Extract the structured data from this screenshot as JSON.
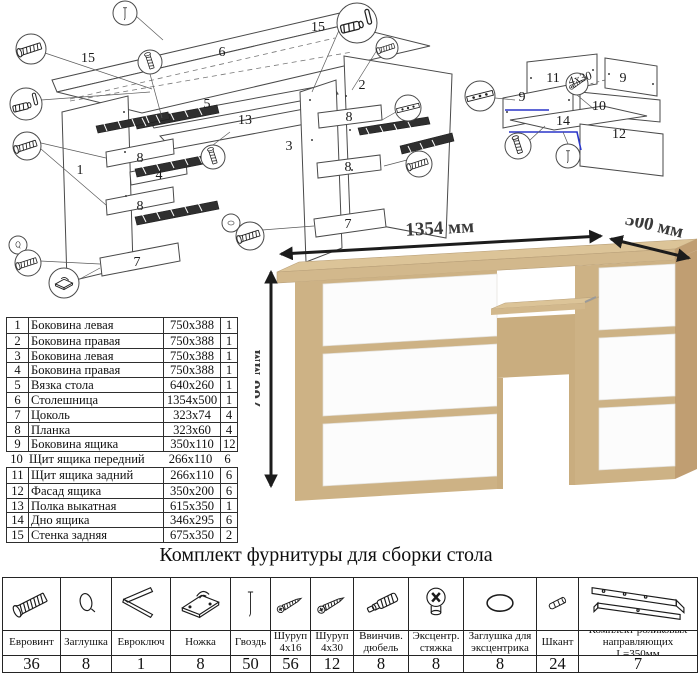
{
  "title": "Комплект фурнитуры для сборки стола",
  "render": {
    "width_label": "1354 мм",
    "depth_label": "500 мм",
    "height_label": "766 мм"
  },
  "colors": {
    "oak_top": "#dcc498",
    "oak_front": "#d2b88c",
    "oak_side": "#c09e72",
    "oak_inner": "#c9ad7f",
    "oak_mid": "#cdb285",
    "white_front": "#fcfcfc",
    "white_edge": "#e3e0da",
    "arrow": "#1c1c1c",
    "dim_text": "#3a3a3a",
    "line": "#4a4a4a",
    "highlight_blue": "#2a35c8"
  },
  "parts_table": {
    "rows": [
      {
        "num": "1",
        "name": "Боковина левая",
        "size": "750x388",
        "qty": "1"
      },
      {
        "num": "2",
        "name": "Боковина правая",
        "size": "750x388",
        "qty": "1"
      },
      {
        "num": "3",
        "name": "Боковина левая",
        "size": "750x388",
        "qty": "1"
      },
      {
        "num": "4",
        "name": "Боковина правая",
        "size": "750x388",
        "qty": "1"
      },
      {
        "num": "5",
        "name": "Вязка стола",
        "size": "640x260",
        "qty": "1"
      },
      {
        "num": "6",
        "name": "Столешница",
        "size": "1354x500",
        "qty": "1"
      },
      {
        "num": "7",
        "name": "Цоколь",
        "size": "323x74",
        "qty": "4"
      },
      {
        "num": "8",
        "name": "Планка",
        "size": "323x60",
        "qty": "4"
      },
      {
        "num": "9",
        "name": "Боковина ящика",
        "size": "350x110",
        "qty": "12"
      },
      {
        "num": "10",
        "name": "Щит ящика передний",
        "size": "266x110",
        "qty": "6"
      },
      {
        "num": "11",
        "name": "Щит ящика задний",
        "size": "266x110",
        "qty": "6"
      },
      {
        "num": "12",
        "name": "Фасад ящика",
        "size": "350x200",
        "qty": "6"
      },
      {
        "num": "13",
        "name": "Полка выкатная",
        "size": "615x350",
        "qty": "1"
      },
      {
        "num": "14",
        "name": "Дно ящика",
        "size": "346x295",
        "qty": "6"
      },
      {
        "num": "15",
        "name": "Стенка задняя",
        "size": "675x350",
        "qty": "2"
      }
    ]
  },
  "hardware": {
    "items": [
      {
        "name": "Евровинт",
        "qty": "36",
        "icon": "euro-screw"
      },
      {
        "name": "Заглушка",
        "qty": "8",
        "icon": "cap"
      },
      {
        "name": "Евроключ",
        "qty": "1",
        "icon": "hex-key"
      },
      {
        "name": "Ножка",
        "qty": "8",
        "icon": "foot"
      },
      {
        "name": "Гвоздь",
        "qty": "50",
        "icon": "nail"
      },
      {
        "name": "Шуруп 4х16",
        "qty": "56",
        "icon": "screw"
      },
      {
        "name": "Шуруп 4х30",
        "qty": "12",
        "icon": "screw"
      },
      {
        "name": "Ввинчив. дюбель",
        "qty": "8",
        "icon": "dowel-threaded"
      },
      {
        "name": "Эксцентр. стяжка",
        "qty": "8",
        "icon": "cam-lock"
      },
      {
        "name": "Заглушка для эксцентрика",
        "qty": "8",
        "icon": "oval-cap"
      },
      {
        "name": "Шкант",
        "qty": "24",
        "icon": "wood-dowel"
      },
      {
        "name": "Комплект роликовых направляющих L=350мм",
        "qty": "7",
        "icon": "drawer-slide"
      }
    ]
  },
  "diagram_main": {
    "labels": [
      {
        "t": "15",
        "x": 88,
        "y": 62
      },
      {
        "t": "6",
        "x": 222,
        "y": 56
      },
      {
        "t": "15",
        "x": 318,
        "y": 31
      },
      {
        "t": "5",
        "x": 207,
        "y": 108
      },
      {
        "t": "13",
        "x": 245,
        "y": 124
      },
      {
        "t": "2",
        "x": 362,
        "y": 89
      },
      {
        "t": "3",
        "x": 289,
        "y": 150
      },
      {
        "t": "1",
        "x": 80,
        "y": 174
      },
      {
        "t": "8",
        "x": 140,
        "y": 162
      },
      {
        "t": "4",
        "x": 159,
        "y": 179
      },
      {
        "t": "8",
        "x": 140,
        "y": 210
      },
      {
        "t": "8",
        "x": 349,
        "y": 121
      },
      {
        "t": "8",
        "x": 348,
        "y": 171
      },
      {
        "t": "7",
        "x": 137,
        "y": 266
      },
      {
        "t": "7",
        "x": 348,
        "y": 228
      }
    ],
    "callouts": [
      {
        "icon": "euro-screw",
        "x": 31,
        "y": 49,
        "r": 15
      },
      {
        "icon": "nail",
        "x": 125,
        "y": 13,
        "r": 12
      },
      {
        "icon": "dowel-pin",
        "x": 357,
        "y": 23,
        "r": 20
      },
      {
        "icon": "euro-screw",
        "x": 387,
        "y": 48,
        "r": 11
      },
      {
        "icon": "dowel-pin",
        "x": 26,
        "y": 104,
        "r": 16
      },
      {
        "icon": "euro-screw",
        "x": 27,
        "y": 146,
        "r": 14
      },
      {
        "icon": "cap",
        "x": 18,
        "y": 245,
        "r": 9
      },
      {
        "icon": "euro-screw",
        "x": 28,
        "y": 263,
        "r": 13
      },
      {
        "icon": "foot",
        "x": 64,
        "y": 283,
        "r": 15
      },
      {
        "icon": "screw-v",
        "x": 150,
        "y": 62,
        "r": 12
      },
      {
        "icon": "screw-v",
        "x": 213,
        "y": 157,
        "r": 12
      },
      {
        "icon": "slide",
        "x": 408,
        "y": 108,
        "r": 13
      },
      {
        "icon": "euro-screw",
        "x": 419,
        "y": 164,
        "r": 13
      },
      {
        "icon": "oval-cap",
        "x": 231,
        "y": 223,
        "r": 9
      },
      {
        "icon": "euro-screw",
        "x": 250,
        "y": 236,
        "r": 14
      }
    ]
  },
  "diagram_drawer": {
    "labels": [
      {
        "t": "11",
        "x": 98,
        "y": 42
      },
      {
        "t": "9",
        "x": 67,
        "y": 61
      },
      {
        "t": "9",
        "x": 168,
        "y": 42
      },
      {
        "t": "10",
        "x": 144,
        "y": 70
      },
      {
        "t": "14",
        "x": 108,
        "y": 85
      },
      {
        "t": "12",
        "x": 164,
        "y": 98
      }
    ],
    "note": "4х30",
    "callouts": [
      {
        "icon": "slide",
        "x": 25,
        "y": 56,
        "r": 15
      },
      {
        "icon": "screw-v",
        "x": 63,
        "y": 106,
        "r": 13
      },
      {
        "icon": "nail",
        "x": 113,
        "y": 116,
        "r": 12
      },
      {
        "icon": "screw",
        "x": 122,
        "y": 44,
        "r": 11
      }
    ]
  }
}
